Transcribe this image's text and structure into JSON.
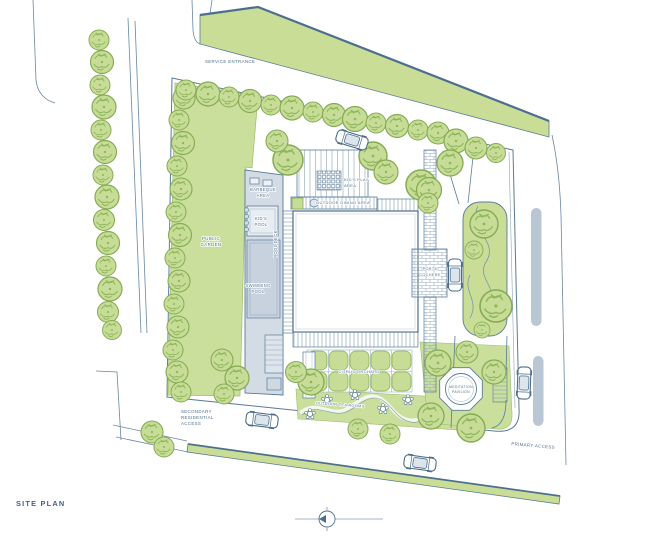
{
  "title": "SITE PLAN",
  "colors": {
    "linework": "#4d6d8b",
    "linework_light": "#8fa6ba",
    "green_fill": "#c9dd97",
    "garden_fill": "#cadf9c",
    "tree_fill": "#c6dc97",
    "tree_stroke": "#85ab52",
    "pool_deck_fill": "#d3dce5",
    "pool_water_fill": "#c7d2de",
    "road_marking_fill": "#b9c7d4",
    "label_text": "#4e6f8b"
  },
  "labels": {
    "service_entrance": "SERVICE ENTRANCE",
    "public_garden": [
      "PUBLIC",
      "GARDEN"
    ],
    "barbeque_area": [
      "BARBEQUE",
      "AREA"
    ],
    "kids_pool": [
      "KID'S",
      "POOL"
    ],
    "pool_deck": "POOL DECK",
    "swimming_pool": [
      "SWIMMING",
      "POOL"
    ],
    "kids_play_area": [
      "KID'S PLAY",
      "AREA"
    ],
    "outdoor_dining_area": "OUTDOOR DINING AREA",
    "porte_cochere": [
      "PORTE",
      "COCHERE"
    ],
    "citrus_orchard": "CITRUS ORCHARD",
    "outdoor_tea_rooms": "OUTDOOR TEA ROOMS",
    "meditation_pavilion": [
      "MEDITATION",
      "PAVILION"
    ],
    "secondary_residential_access": [
      "SECONDARY",
      "RESIDENTIAL",
      "ACCESS"
    ],
    "primary_access": "PRIMARY ACCESS"
  }
}
